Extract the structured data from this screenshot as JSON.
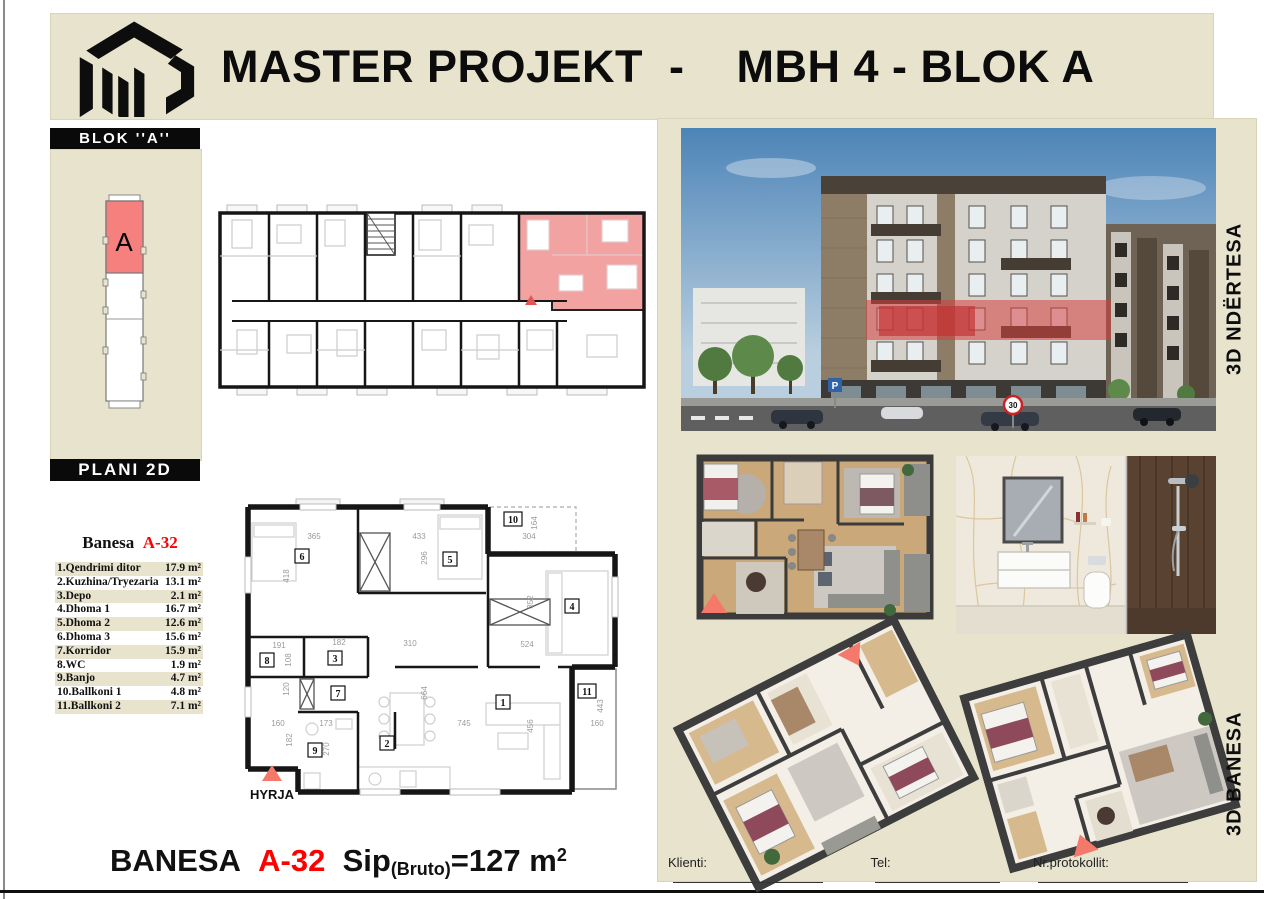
{
  "page": {
    "title": "MASTER PROJEKT  -    MBH 4 - BLOK A"
  },
  "sidebar": {
    "blok_label": "BLOK ''A''",
    "block_letter": "A",
    "plan_label": "PLANI 2D"
  },
  "unit_table": {
    "title_prefix": "Banesa",
    "unit_code": "A-32",
    "rows": [
      {
        "name": "1.Qendrimi ditor",
        "area": "17.9 m²"
      },
      {
        "name": "2.Kuzhina/Tryezaria",
        "area": "13.1 m²"
      },
      {
        "name": "3.Depo",
        "area": "2.1 m²"
      },
      {
        "name": "4.Dhoma 1",
        "area": "16.7 m²"
      },
      {
        "name": "5.Dhoma 2",
        "area": "12.6 m²"
      },
      {
        "name": "6.Dhoma 3",
        "area": "15.6 m²"
      },
      {
        "name": "7.Korridor",
        "area": "15.9 m²"
      },
      {
        "name": "8.WC",
        "area": "1.9 m²"
      },
      {
        "name": "9.Banjo",
        "area": "4.7 m²"
      },
      {
        "name": "10.Ballkoni 1",
        "area": "4.8 m²"
      },
      {
        "name": "11.Ballkoni  2",
        "area": "7.1 m²"
      }
    ]
  },
  "plan2d": {
    "entrance_label": "HYRJA",
    "room_numbers": [
      "1",
      "2",
      "3",
      "4",
      "5",
      "6",
      "7",
      "8",
      "9",
      "10",
      "11"
    ],
    "dimensions": [
      "365",
      "433",
      "304",
      "296",
      "164",
      "418",
      "352",
      "191",
      "182",
      "108",
      "310",
      "524",
      "120",
      "664",
      "160",
      "173",
      "182",
      "270",
      "745",
      "456",
      "443",
      "160"
    ]
  },
  "summary": {
    "label": "BANESA",
    "unit_code": "A-32",
    "sip": "Sip",
    "bruto": "(Bruto)",
    "value": "=127 m",
    "sup": "2"
  },
  "right_panel": {
    "building_caption": "3D NDËRTESA",
    "banesa_caption": "3D BANESA",
    "speed_sign": "30",
    "parking_sign": "P",
    "footer": {
      "klienti": "Klienti:",
      "tel": "Tel:",
      "protokoll": "Nr.protokollit:"
    }
  },
  "colors": {
    "beige": "#e8e3cd",
    "accent_red": "#fe0000",
    "salmon": "#f4796b",
    "plan_highlight": "#f3a2a2",
    "black": "#0a0a0a"
  }
}
